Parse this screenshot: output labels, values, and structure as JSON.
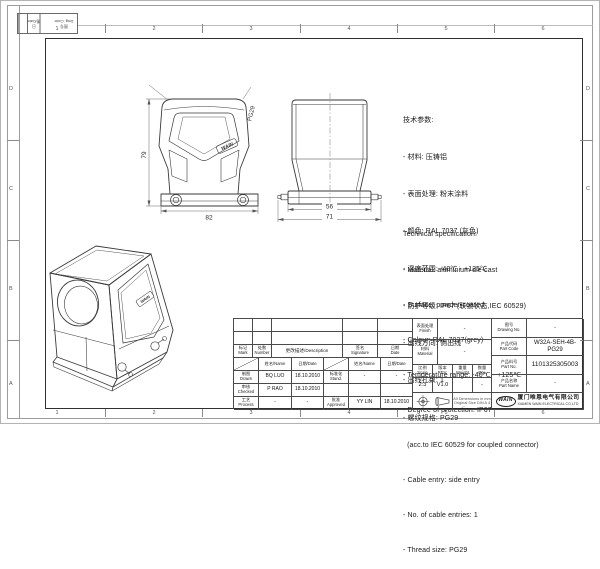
{
  "sheet": {
    "grid_top": [
      "1",
      "2",
      "3",
      "4",
      "5",
      "6"
    ],
    "grid_bottom": [
      "1",
      "2",
      "3",
      "4",
      "5",
      "6"
    ],
    "grid_left": [
      "D",
      "C",
      "B",
      "A"
    ],
    "grid_right": [
      "D",
      "C",
      "B",
      "A"
    ],
    "corner": {
      "date": "日期/Date",
      "dwg": "图号\nDwg. Code"
    }
  },
  "views": {
    "front": {
      "dim_height": "79",
      "dim_width": "82",
      "thread": "PG29",
      "logo": "WAIN"
    },
    "side": {
      "dim_inner": "56",
      "dim_outer": "71"
    },
    "iso": {
      "logo": "WAIN"
    }
  },
  "specs_cn": {
    "title": "技术参数:",
    "items": [
      "- 材料: 压铸铝",
      "- 表面处理: 粉末涂料",
      "- 颜色: RAL 7037 (灰色)",
      "- 温度范围: -40℃ - +125℃",
      "- 防护等级: IP67 (联锁状态,IEC 60529)",
      "- 出线方向: 侧出线",
      "- 出线孔数: 1",
      "- 螺纹规格: PG29"
    ]
  },
  "specs_en": {
    "title": "Technical specification:",
    "items": [
      "- Material: aluminium die-cast",
      "- Surface: powder-coated",
      "- Colour: RAL 7037(grey)",
      "- Temperature range: -40℃ - +125℃",
      "- Degree of protection: IP67",
      "  (acc.to IEC 60529 for coupled connector)",
      "- Cable entry: side entry",
      "- No. of cable entries: 1",
      "- Thread size: PG29"
    ]
  },
  "titleblock": {
    "headers": {
      "mark": "标记\nMark",
      "number": "处数\nNumber",
      "description": "更改描述/Description",
      "signature": "签名\nSignature",
      "date": "日期\nDate",
      "name_hdr": "姓名/Name",
      "date_hdr": "日期/Date"
    },
    "rows": {
      "drawn_label": "制图\nDrawn",
      "drawn_name": "BQ LUO",
      "drawn_date": "18.10.2010",
      "stand_label": "标准化\nStand.",
      "stand_name": "-",
      "stand_date": "-",
      "checked_label": "审核\nChecked",
      "checked_name": "P RAO",
      "checked_date": "18.10.2010",
      "process_label": "工艺\nProcess",
      "process_name": "-",
      "process_date": "-",
      "approved_label": "批准\nApproved",
      "approved_name": "YY LIN",
      "approved_date": "18.10.2010"
    },
    "finish_label": "表面处理\nFinish",
    "finish_value": "-",
    "material_label": "材料\nMaterial",
    "material_value": "-",
    "scale_label": "比例\nScale",
    "scale_value": "2:3",
    "rev_label": "版本\nREV.",
    "rev_value": "V1.0",
    "weight_label": "重量\nWeight",
    "weight_value": "",
    "qty_label": "数量\nQty.",
    "qty_value": "-",
    "notes": "All Dimensions in mm\nOriginal Size DIN A 4",
    "drawing_no_label": "图号\nDrawing No.",
    "drawing_no_value": "-",
    "part_code_label": "产品代码\nPart Code",
    "part_code_value": "W32A-SEH-4B-PG29",
    "part_no_label": "产品料号\nPart No.",
    "part_no_value": "1101325305003",
    "part_name_label": "产品名称\nPart Name",
    "part_name_value": "-",
    "company_logo": "WAIN",
    "company_cn": "厦门唯恩电气有限公司",
    "company_en": "XIAMEN WAIN ELECTRICAL CO.LTD"
  }
}
